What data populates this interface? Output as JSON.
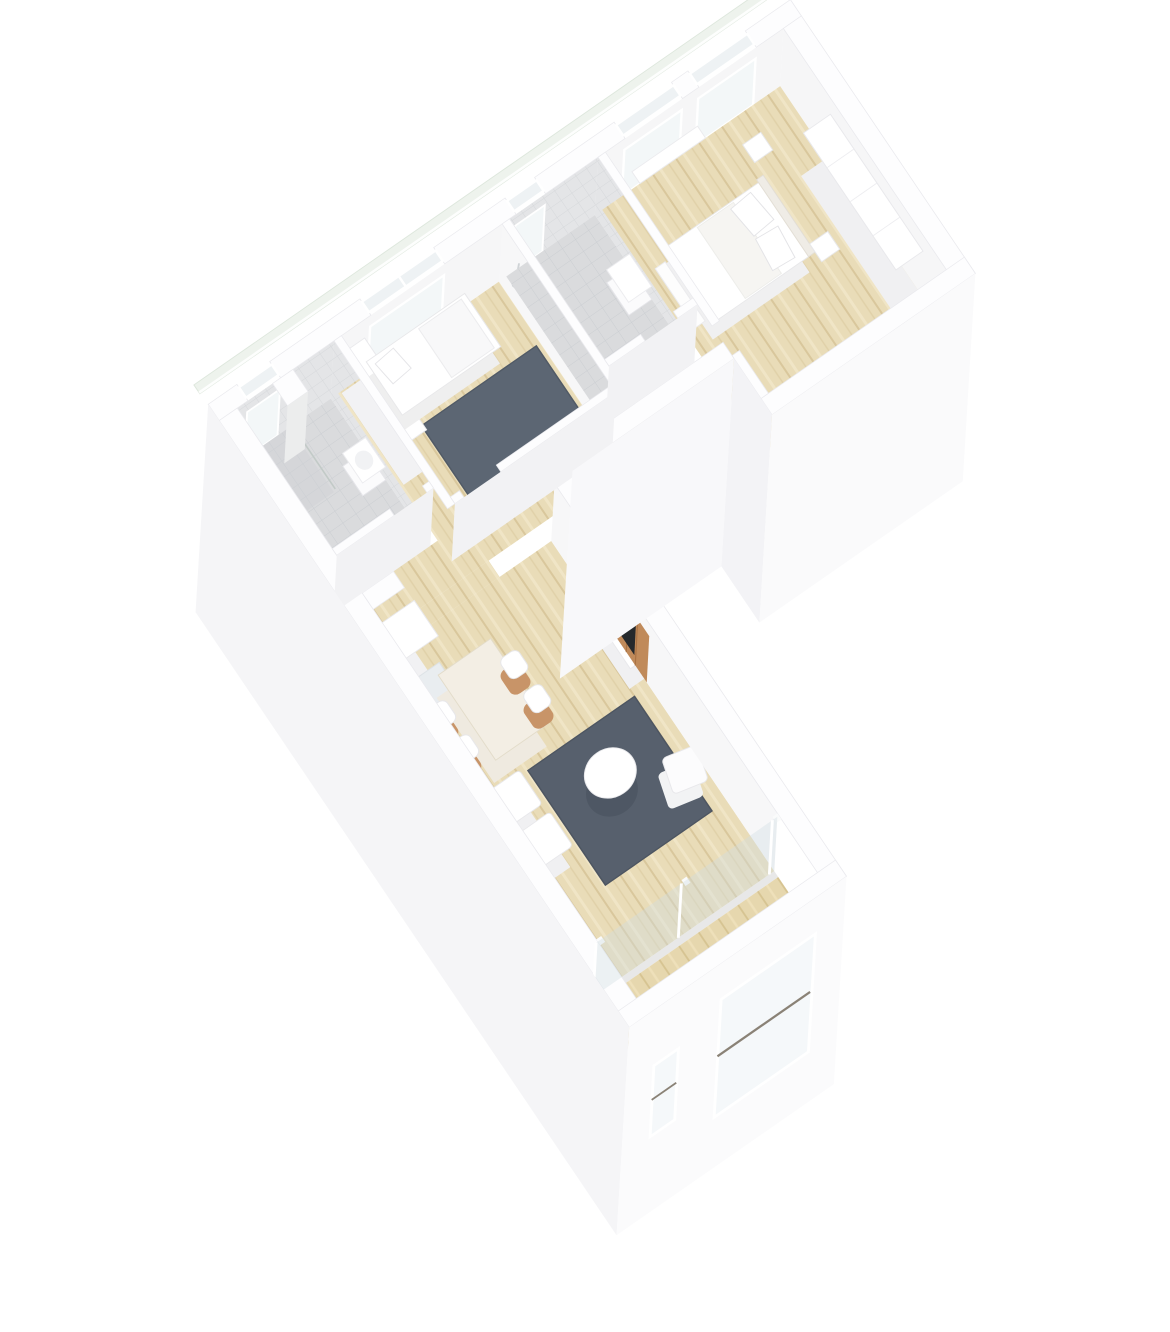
{
  "scene": {
    "type": "3d-floor-plan-render",
    "style": "isometric cutaway, white walls, no text labels",
    "apartment_shape": "L-shaped, rotated ~35 degrees",
    "rooms": [
      {
        "name": "bathroom-1",
        "floor": "grey tile",
        "fixtures": [
          "shower-area",
          "wall-niche",
          "washbasin",
          "toilet"
        ]
      },
      {
        "name": "bedroom-2",
        "floor": "light wood",
        "furniture": [
          "single-bed",
          "wardrobe-units",
          "dark-grey-rug"
        ]
      },
      {
        "name": "bathroom-2",
        "floor": "grey tile",
        "fixtures": [
          "shower-head",
          "washbasin",
          "toilet"
        ]
      },
      {
        "name": "master-bedroom",
        "floor": "light wood",
        "furniture": [
          "double-bed",
          "pillows",
          "nightstands",
          "wardrobe-row",
          "window-bench"
        ]
      },
      {
        "name": "hallway",
        "floor": "light wood",
        "features": [
          "doors-to-all-rooms",
          "entry-opening-to-living-room"
        ]
      },
      {
        "name": "living-room",
        "floor": "light wood",
        "furniture": [
          "entry-closet",
          "dining-table",
          "four-wood-chairs",
          "two-white-armchairs",
          "dark-grey-rug",
          "round-coffee-table",
          "white-lounge-chair",
          "tv-console",
          "wood-slat-media-wall",
          "tv-screen"
        ]
      },
      {
        "name": "balcony",
        "floor": "wood deck",
        "features": [
          "glazed-sliding-wall",
          "front-wall-with-two-windows"
        ]
      }
    ],
    "exterior": [
      "glass-balustrade-strip-along-top-wall",
      "white-cut-walls",
      "tall-exterior-wall-faces",
      "window-openings"
    ]
  },
  "palette": {
    "bg": "#ffffff",
    "wall_cap": "#fdfdfe",
    "wall_face": "#f6f6f8",
    "wall_face_dark": "#efeff2",
    "wood_floor": "#e9dcb8",
    "wood_line": "#d9c79c",
    "deck": "#e6d7ae",
    "tile_floor": "#dadbdd",
    "tile_line": "#cbced2",
    "tile_wall": "#e4e5e7",
    "rug": "#57606d",
    "slat_wood": "#c08a5a",
    "chair_wood": "#c89468",
    "tv": "#26292c",
    "glass": "#edf2ec",
    "window_glass": "#f3f7f8"
  }
}
